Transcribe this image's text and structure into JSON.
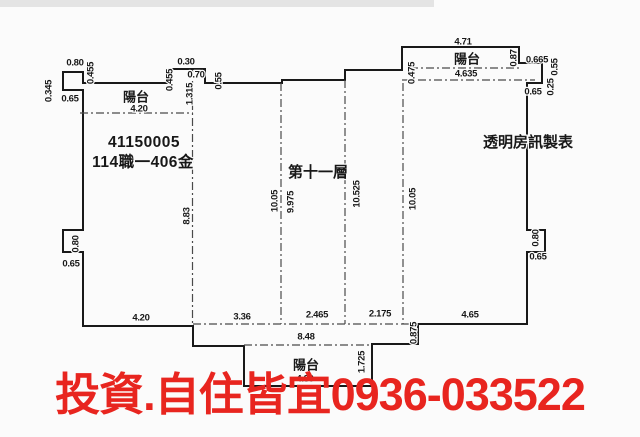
{
  "plan": {
    "floor_title": "第十一層",
    "registry_number": "41150005",
    "parcel_code": "114職一406金",
    "maker_credit": "透明房訊製表",
    "balcony_word": "陽台"
  },
  "overlay": {
    "ad_text": "投資.自住皆宜0936-033522",
    "color": "#e8251f"
  },
  "colors": {
    "line": "#191919",
    "dashed": "#4a4a4a",
    "background": "#fbfbfb"
  },
  "labels": [
    {
      "text": "0.80",
      "x": 75,
      "y": 63,
      "cls": "dim",
      "name": "dim-top-left-bump-width"
    },
    {
      "text": "0.345",
      "x": 49,
      "y": 91,
      "rot": -90,
      "cls": "dim",
      "name": "dim-top-left-bump-height"
    },
    {
      "text": "0.65",
      "x": 70,
      "y": 99,
      "cls": "dim",
      "name": "dim-top-left-bump-offset"
    },
    {
      "text": "0.455",
      "x": 91,
      "y": 73,
      "rot": -90,
      "cls": "dim",
      "name": "dim-top-left-wall"
    },
    {
      "text": "陽台",
      "x": 136,
      "y": 98,
      "cls": "cjk12",
      "name": "balcony-label-top-left"
    },
    {
      "text": "4.20",
      "x": 139,
      "y": 109,
      "cls": "dim",
      "name": "dim-balcony-top-left-width"
    },
    {
      "text": "0.30",
      "x": 186,
      "y": 62,
      "cls": "dim",
      "name": "dim-top-notch-a"
    },
    {
      "text": "0.455",
      "x": 170,
      "y": 80,
      "rot": -90,
      "cls": "dim",
      "name": "dim-top-notch-rise"
    },
    {
      "text": "0.70",
      "x": 196,
      "y": 75,
      "cls": "dim",
      "name": "dim-top-notch-b"
    },
    {
      "text": "1.315",
      "x": 190,
      "y": 94,
      "rot": -90,
      "cls": "dim",
      "name": "dim-top-notch-depth"
    },
    {
      "text": "0.55",
      "x": 219,
      "y": 81,
      "rot": -90,
      "cls": "dim",
      "name": "dim-top-notch-drop"
    },
    {
      "text": "4.71",
      "x": 463,
      "y": 42,
      "cls": "dim",
      "name": "dim-balcony-top-right-outer"
    },
    {
      "text": "陽台",
      "x": 467,
      "y": 60,
      "cls": "cjk12",
      "name": "balcony-label-top-right"
    },
    {
      "text": "4.635",
      "x": 466,
      "y": 74,
      "cls": "dim",
      "name": "dim-balcony-top-right-inner"
    },
    {
      "text": "0.475",
      "x": 412,
      "y": 73,
      "rot": -90,
      "cls": "dim",
      "name": "dim-balcony-top-right-side"
    },
    {
      "text": "0.87",
      "x": 514,
      "y": 58,
      "rot": -90,
      "cls": "dim",
      "name": "dim-top-right-step-a"
    },
    {
      "text": "0.665",
      "x": 537,
      "y": 60,
      "cls": "dim",
      "name": "dim-top-right-step-b"
    },
    {
      "text": "0.55",
      "x": 555,
      "y": 67,
      "rot": -90,
      "cls": "dim",
      "name": "dim-top-right-step-c"
    },
    {
      "text": "0.25",
      "x": 551,
      "y": 87,
      "rot": -90,
      "cls": "dim",
      "name": "dim-top-right-step-d"
    },
    {
      "text": "0.65",
      "x": 533,
      "y": 92,
      "cls": "dim",
      "name": "dim-top-right-step-e"
    },
    {
      "text": "41150005",
      "x": 144,
      "y": 143,
      "cls": "num15",
      "name": "registry-number"
    },
    {
      "text": "114職一406金",
      "x": 143,
      "y": 163,
      "cls": "num15",
      "name": "parcel-code"
    },
    {
      "text": "第十一層",
      "x": 318,
      "y": 173,
      "cls": "cjk14",
      "name": "floor-title"
    },
    {
      "text": "透明房訊製表",
      "x": 528,
      "y": 143,
      "cls": "cjk14",
      "name": "maker-credit"
    },
    {
      "text": "8.83",
      "x": 187,
      "y": 216,
      "rot": -90,
      "cls": "dim",
      "name": "dim-interior-left-height"
    },
    {
      "text": "10.05",
      "x": 275,
      "y": 201,
      "rot": -90,
      "cls": "dim",
      "name": "dim-interior-mid-left-height"
    },
    {
      "text": "9.975",
      "x": 291,
      "y": 202,
      "rot": -90,
      "cls": "dim",
      "name": "dim-interior-mid-left-inner"
    },
    {
      "text": "10.525",
      "x": 357,
      "y": 194,
      "rot": -90,
      "cls": "dim",
      "name": "dim-interior-mid-right-height"
    },
    {
      "text": "10.05",
      "x": 413,
      "y": 199,
      "rot": -90,
      "cls": "dim",
      "name": "dim-interior-right-height"
    },
    {
      "text": "0.80",
      "x": 76,
      "y": 244,
      "rot": -90,
      "cls": "dim",
      "name": "dim-left-bump-width"
    },
    {
      "text": "0.65",
      "x": 71,
      "y": 264,
      "cls": "dim",
      "name": "dim-left-bump-offset"
    },
    {
      "text": "0.80",
      "x": 536,
      "y": 238,
      "rot": -90,
      "cls": "dim",
      "name": "dim-right-bump-width"
    },
    {
      "text": "0.65",
      "x": 538,
      "y": 257,
      "cls": "dim",
      "name": "dim-right-bump-offset"
    },
    {
      "text": "4.20",
      "x": 141,
      "y": 318,
      "cls": "dim",
      "name": "dim-bottom-left-width"
    },
    {
      "text": "3.36",
      "x": 242,
      "y": 317,
      "cls": "dim",
      "name": "dim-bottom-span-a"
    },
    {
      "text": "2.465",
      "x": 317,
      "y": 315,
      "cls": "dim",
      "name": "dim-bottom-span-b"
    },
    {
      "text": "2.175",
      "x": 380,
      "y": 314,
      "cls": "dim",
      "name": "dim-bottom-span-c"
    },
    {
      "text": "4.65",
      "x": 470,
      "y": 315,
      "cls": "dim",
      "name": "dim-bottom-right-width"
    },
    {
      "text": "8.48",
      "x": 306,
      "y": 337,
      "cls": "dim",
      "name": "dim-bottom-total-width"
    },
    {
      "text": "0.875",
      "x": 414,
      "y": 333,
      "rot": -90,
      "cls": "dim",
      "name": "dim-bottom-step-height"
    },
    {
      "text": "1.725",
      "x": 362,
      "y": 362,
      "rot": -90,
      "cls": "dim",
      "name": "dim-bottom-balcony-depth"
    },
    {
      "text": "陽台",
      "x": 306,
      "y": 366,
      "cls": "cjk12",
      "name": "balcony-label-bottom"
    },
    {
      "text": "4.80",
      "x": 305,
      "y": 379,
      "cls": "dim",
      "name": "dim-balcony-bottom-width"
    }
  ]
}
